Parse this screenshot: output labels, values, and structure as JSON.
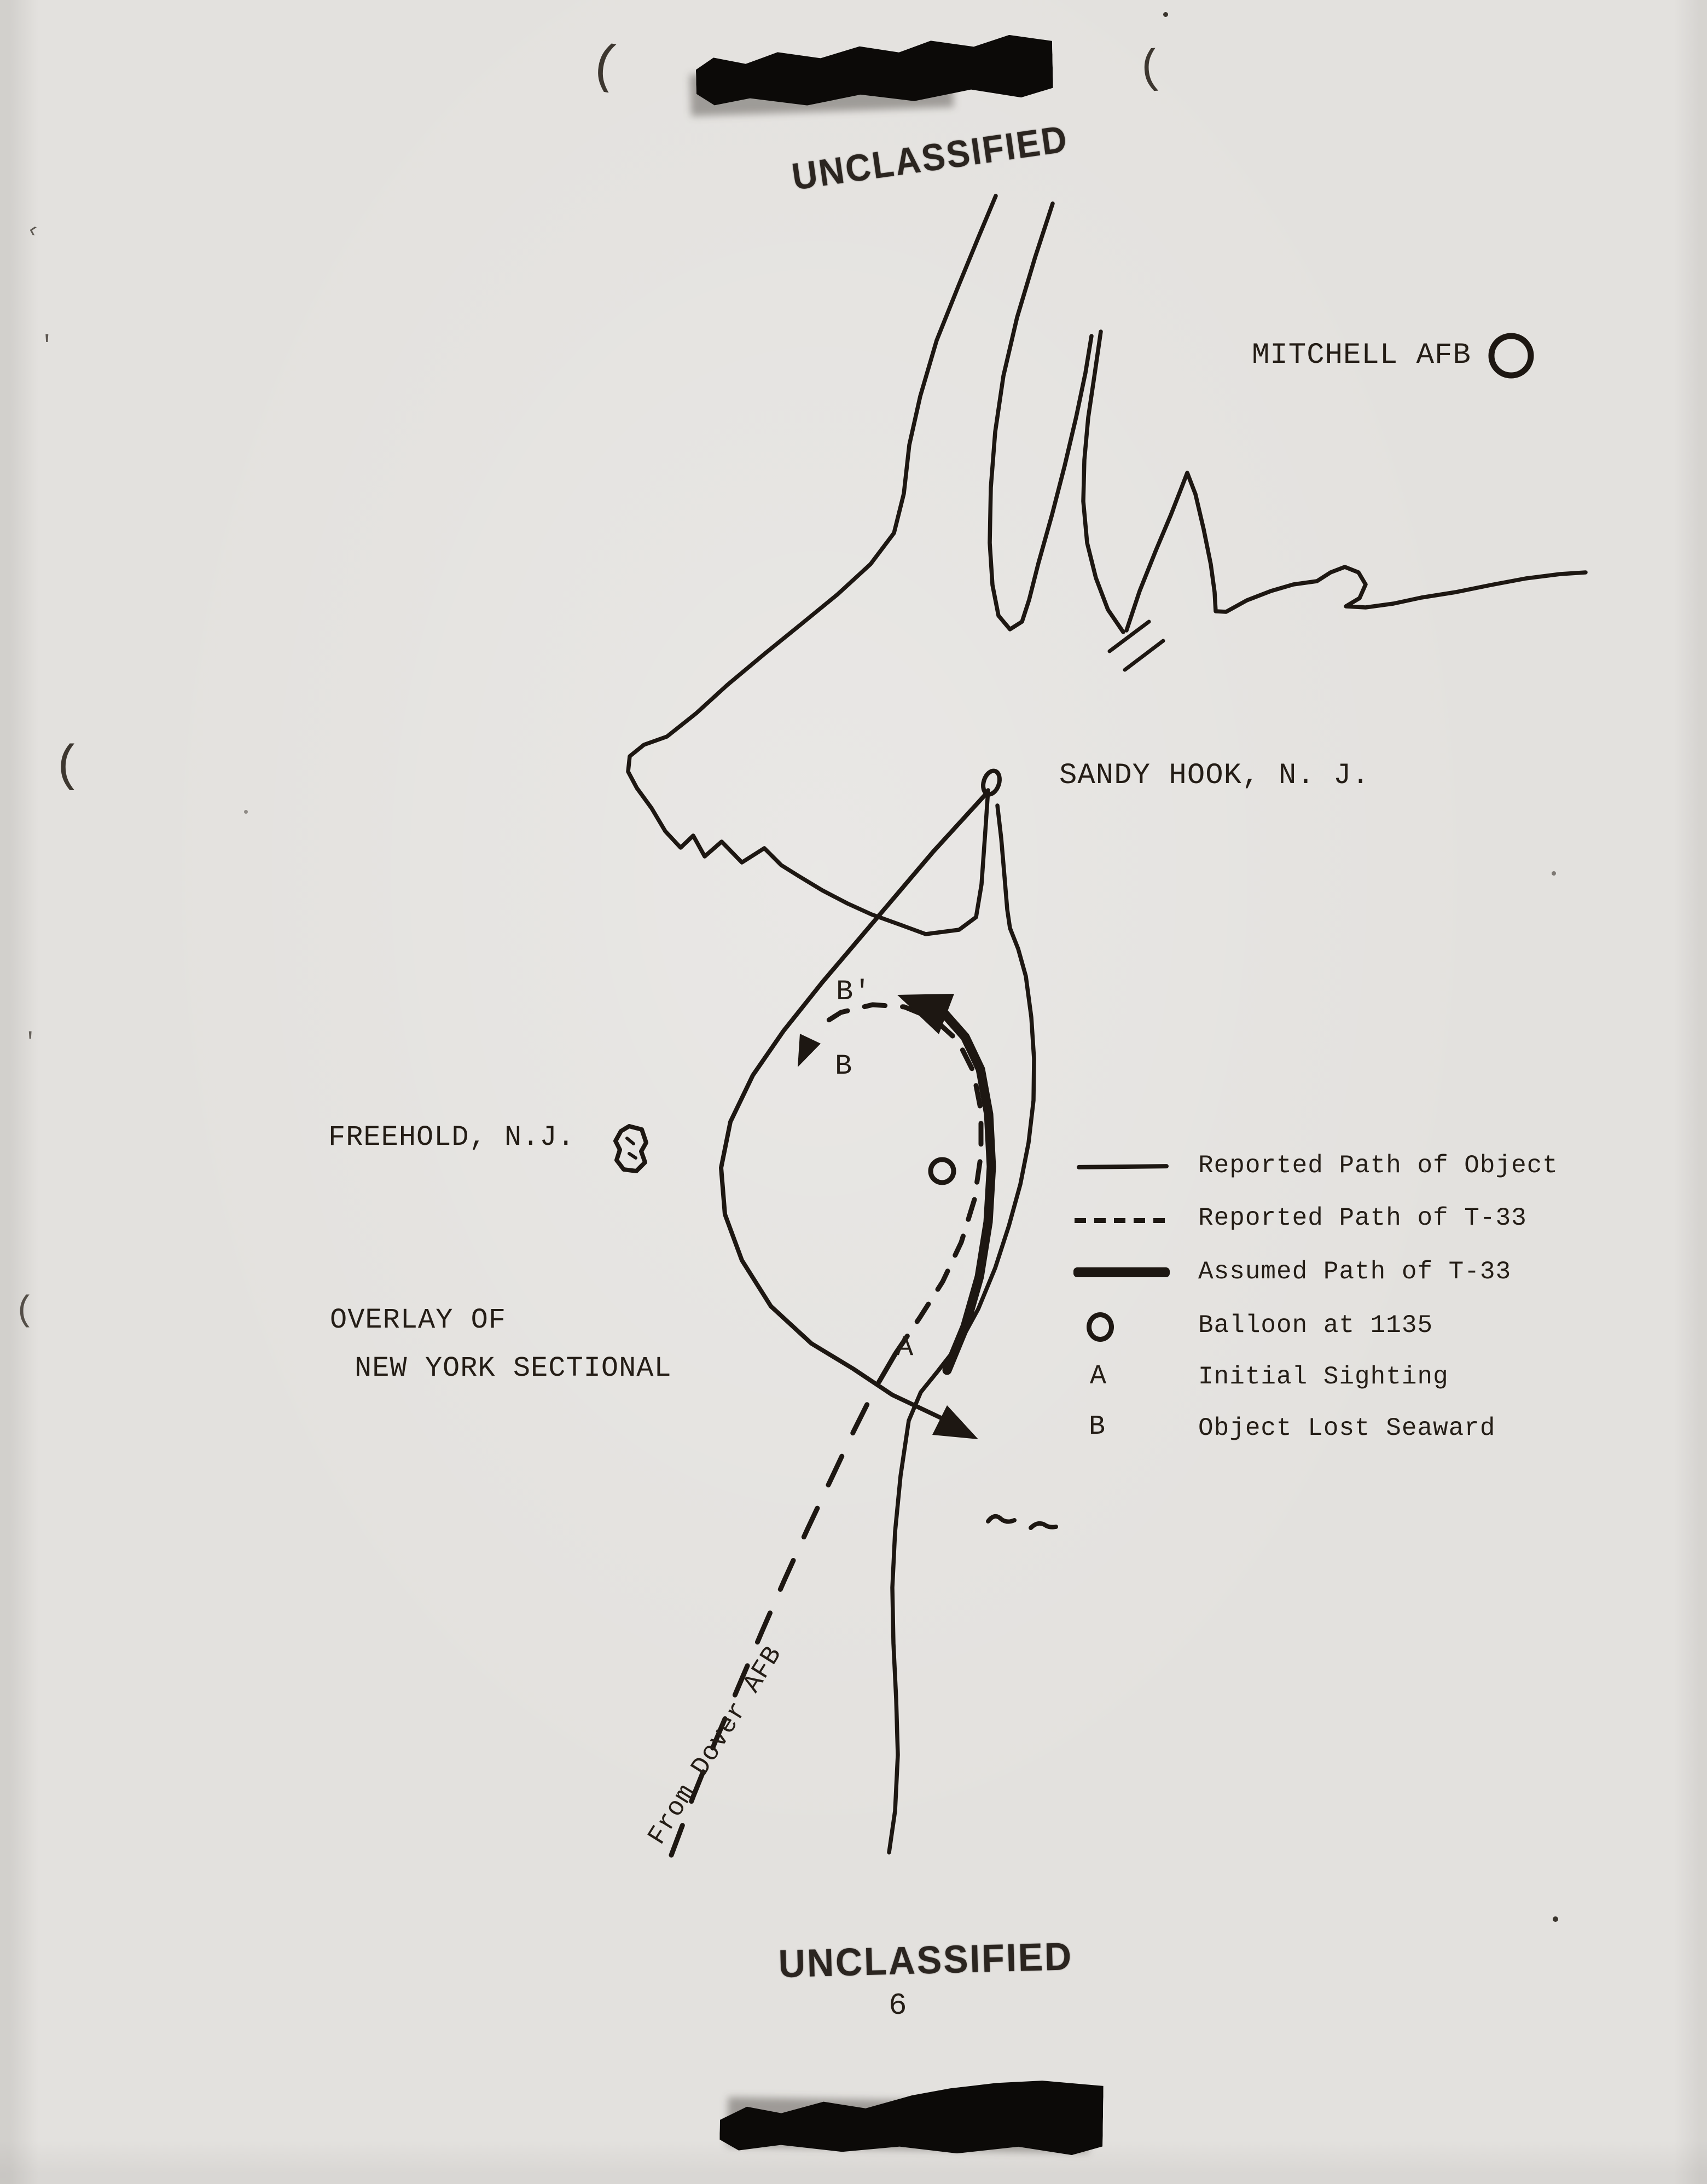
{
  "document": {
    "classification_stamp_top": "UNCLASSIFIED",
    "classification_stamp_bottom": "UNCLASSIFIED",
    "page_number": "6",
    "paper_color": "#e3e1de",
    "ink_color": "#1d1712"
  },
  "map": {
    "title_line1": "OVERLAY OF",
    "title_line2": "NEW YORK SECTIONAL",
    "labels": {
      "mitchell_afb": "MITCHELL AFB",
      "sandy_hook": "SANDY HOOK, N. J.",
      "freehold": "FREEHOLD, N.J.",
      "from_dover": "From Dover AFB",
      "point_b_prime": "B'",
      "point_b": "B",
      "point_a": "A"
    }
  },
  "legend": {
    "items": [
      {
        "symbol": "solid-line",
        "marker": "",
        "label": "Reported Path of Object"
      },
      {
        "symbol": "dashed-line",
        "marker": "",
        "label": "Reported Path of T-33"
      },
      {
        "symbol": "thick-line",
        "marker": "",
        "label": "Assumed Path of T-33"
      },
      {
        "symbol": "circle",
        "marker": "O",
        "label": "Balloon at 1135"
      },
      {
        "symbol": "letter",
        "marker": "A",
        "label": "Initial Sighting"
      },
      {
        "symbol": "letter",
        "marker": "B",
        "label": "Object Lost Seaward"
      }
    ]
  }
}
